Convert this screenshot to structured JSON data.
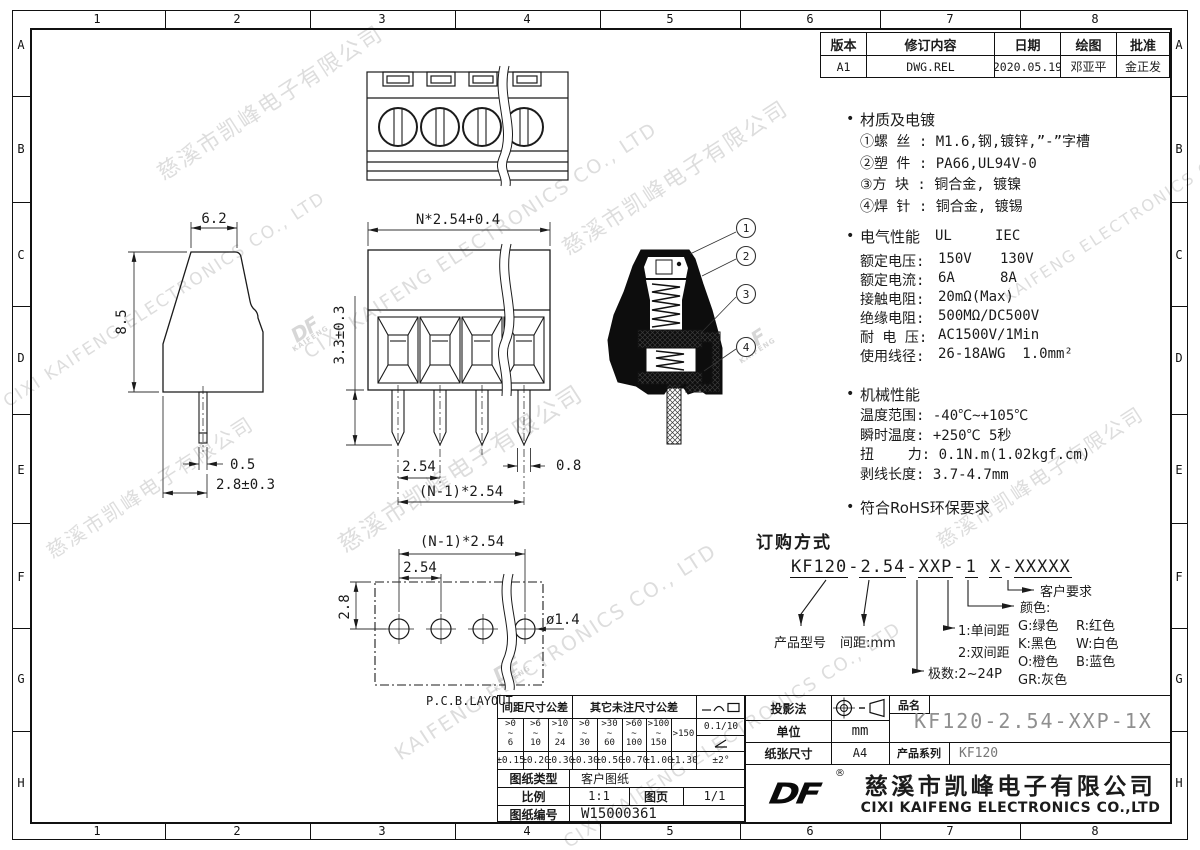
{
  "frame": {
    "cols": [
      "1",
      "2",
      "3",
      "4",
      "5",
      "6",
      "7",
      "8"
    ],
    "rows": [
      "A",
      "B",
      "C",
      "D",
      "E",
      "F",
      "G",
      "H"
    ]
  },
  "colors": {
    "line": "#1b1b1b",
    "muted": "#8f8f8f",
    "watermark": "#b5b5b5"
  },
  "revision": {
    "headers": [
      "版本",
      "修订内容",
      "日期",
      "绘图",
      "批准"
    ],
    "row": {
      "version": "A1",
      "content": "DWG.REL",
      "date": "2020.05.19",
      "drawn": "邓亚平",
      "approved": "金正发"
    }
  },
  "notes": {
    "bullet": "•",
    "material": {
      "title": "材质及电镀",
      "items": "①螺 丝 : M1.6,钢,镀锌,”-”字槽\n②塑 件 : PA66,UL94V-0\n③方 块 : 铜合金, 镀镍\n④焊 针 : 铜合金, 镀锡"
    },
    "electrical": {
      "title": "电气性能",
      "ul": "UL",
      "iec": "IEC",
      "rows": [
        {
          "label": "额定电压:",
          "v1": "150V",
          "v2": "130V"
        },
        {
          "label": "额定电流:",
          "v1": "6A",
          "v2": "8A"
        },
        {
          "label": "接触电阻:",
          "v1": "20mΩ(Max)",
          "v2": ""
        },
        {
          "label": "绝缘电阻:",
          "v1": "500MΩ/DC500V",
          "v2": ""
        },
        {
          "label": "耐 电 压:",
          "v1": "AC1500V/1Min",
          "v2": ""
        },
        {
          "label": "使用线径:",
          "v1": "26-18AWG  1.0mm²",
          "v2": ""
        }
      ]
    },
    "mechanical": {
      "title": "机械性能",
      "items": "温度范围: -40℃~+105℃\n瞬时温度: +250℃ 5秒\n扭    力: 0.1N.m(1.02kgf.cm)\n剥线长度: 3.7-4.7mm"
    },
    "rohs": "符合RoHS环保要求"
  },
  "ordering": {
    "title": "订购方式",
    "pn": {
      "s1": "KF120",
      "s2": "2.54",
      "s3": "XXP",
      "s4": "1",
      "s5": "X",
      "s6": "XXXXX",
      "dash": "-",
      "space": " "
    },
    "labels": {
      "model": "产品型号",
      "pitch": "间距:mm",
      "poles": "极数:2~24P",
      "single": "1:单间距",
      "double": "2:双间距",
      "color": "颜色:",
      "customer": "客户要求"
    },
    "colors": [
      [
        "G:绿色",
        "R:红色"
      ],
      [
        "K:黑色",
        "W:白色"
      ],
      [
        "O:橙色",
        "B:蓝色"
      ],
      [
        "GR:灰色",
        ""
      ]
    ]
  },
  "titleblock": {
    "projection_label": "投影法",
    "unit_label": "单位",
    "unit_value": "mm",
    "paper_label": "纸张尺寸",
    "paper_value": "A4",
    "part_label": "品名",
    "part_number": "KF120-2.54-XXP-1X",
    "series_label": "产品系列",
    "series_value": "KF120",
    "logo_text": "DF",
    "reg_mark": "®",
    "company_cn": "慈溪市凯峰电子有限公司",
    "company_en": "CIXI KAIFENG ELECTRONICS CO.,LTD"
  },
  "tolerance": {
    "pitch_header": "间距尺寸公差",
    "other_header": "其它未注尺寸公差",
    "ranges": [
      {
        "top": ">0",
        "mid": "~",
        "bot": "6"
      },
      {
        "top": ">6",
        "mid": "~",
        "bot": "10"
      },
      {
        "top": ">10",
        "mid": "~",
        "bot": "24"
      },
      {
        "top": ">0",
        "mid": "~",
        "bot": "30"
      },
      {
        "top": ">30",
        "mid": "~",
        "bot": "60"
      },
      {
        "top": ">60",
        "mid": "~",
        "bot": "100"
      },
      {
        "top": ">100",
        "mid": "~",
        "bot": "150"
      }
    ],
    "last_range": ">150",
    "values": [
      "±0.15",
      "±0.20",
      "±0.30",
      "±0.30",
      "±0.50",
      "±0.70",
      "±1.00",
      "±1.30"
    ],
    "flatness": "0.1/10",
    "angle": "±2°",
    "doc_type_label": "图纸类型",
    "doc_type_value": "客户图纸",
    "scale_label": "比例",
    "scale_value": "1:1",
    "sheet_label": "图页",
    "sheet_value": "1/1",
    "number_label": "图纸编号",
    "number_value": "W15000361"
  },
  "drawing": {
    "dims": {
      "top_width": "6.2",
      "body_height": "8.5",
      "pin_width": "0.5",
      "pin_length": "2.8±0.3",
      "front_width": "N*2.54+0.4",
      "front_height": "3.3±0.3",
      "pitch": "2.54",
      "pin_w": "0.8",
      "span": "(N-1)*2.54",
      "pcb_span": "(N-1)*2.54",
      "pcb_pitch": "2.54",
      "pcb_offset": "2.8",
      "hole_dia": "ø1.4",
      "pcb_label": "P.C.B.LAYOUT"
    },
    "balloons": [
      "1",
      "2",
      "3",
      "4"
    ]
  },
  "watermarks": [
    "慈溪市凯峰电子有限公司",
    "CIXI KAIFENG ELECTRONICS CO., LTD",
    "慈溪市凯峰电子有限公司",
    "CIXI KAIFENG ELECTRONICS CO., LTD",
    "慈溪市凯峰电子有限公司",
    "KAIFENG ELECTRONICS CO., LTD",
    "慈溪市凯峰电子有限公司",
    "KAIFENG ELECTRONICS CO., LTD",
    "慈溪市凯峰电子有限公司",
    "CIXI KAIFENG ELECTRONICS CO., LTD"
  ]
}
